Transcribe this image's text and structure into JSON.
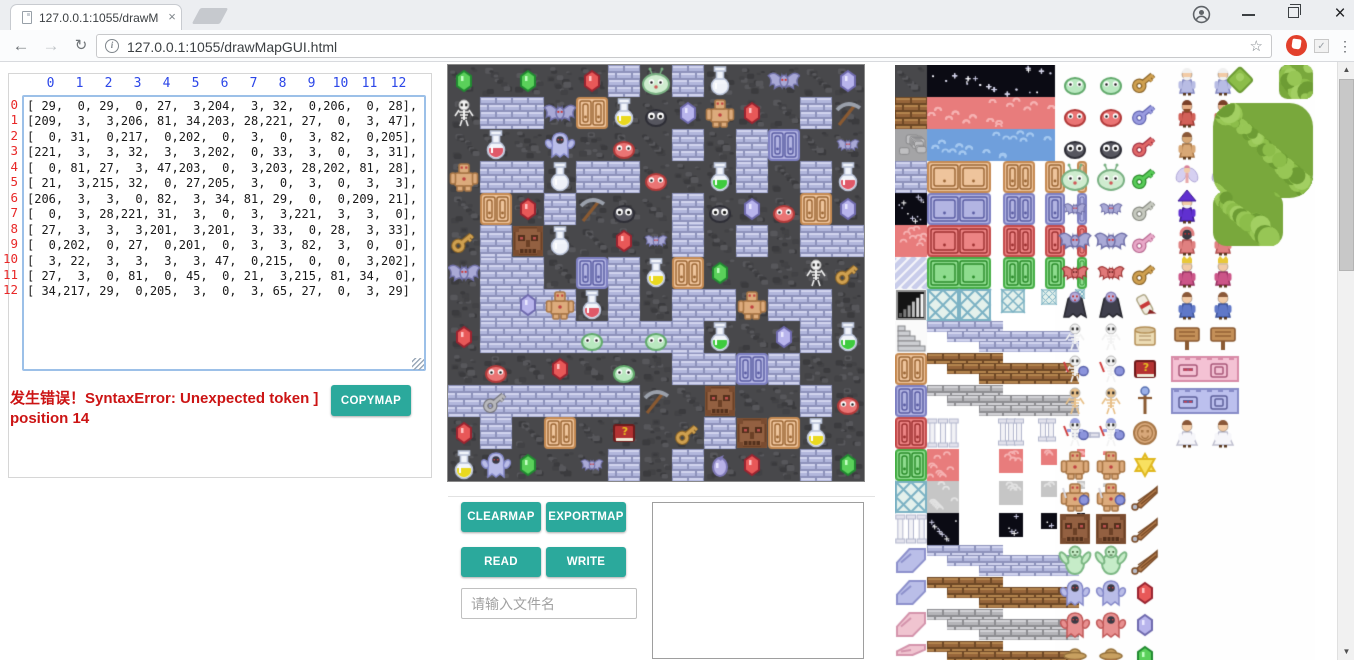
{
  "browser": {
    "tab": {
      "title": "127.0.0.1:1055/drawMa",
      "close": "×"
    },
    "window": {
      "minimize": "—",
      "close": "×"
    },
    "toolbar": {
      "back": "←",
      "forward": "→",
      "reload": "↻",
      "info": "i",
      "url": "127.0.0.1:1055/drawMapGUI.html",
      "bookmark_star": "☆",
      "extension_check": "✓",
      "menu_dots": "⋮"
    }
  },
  "left_panel": {
    "col_headers": [
      "0",
      "1",
      "2",
      "3",
      "4",
      "5",
      "6",
      "7",
      "8",
      "9",
      "10",
      "11",
      "12"
    ],
    "row_headers": [
      "0",
      "1",
      "2",
      "3",
      "4",
      "5",
      "6",
      "7",
      "8",
      "9",
      "10",
      "11",
      "12"
    ],
    "matrix_rows": [
      "[ 29,  0, 29,  0, 27,  3,204,  3, 32,  0,206,  0, 28],",
      "[209,  3,  3,206, 81, 34,203, 28,221, 27,  0,  3, 47],",
      "[  0, 31,  0,217,  0,202,  0,  3,  0,  3, 82,  0,205],",
      "[221,  3,  3, 32,  3,  3,202,  0, 33,  3,  0,  3, 31],",
      "[  0, 81, 27,  3, 47,203,  0,  3,203, 28,202, 81, 28],",
      "[ 21,  3,215, 32,  0, 27,205,  3,  0,  3,  0,  3,  3],",
      "[206,  3,  3,  0, 82,  3, 34, 81, 29,  0,  0,209, 21],",
      "[  0,  3, 28,221, 31,  3,  0,  3,  3,221,  3,  3,  0],",
      "[ 27,  3,  3,  3,201,  3,201,  3, 33,  0, 28,  3, 33],",
      "[  0,202,  0, 27,  0,201,  0,  3,  3, 82,  3,  0,  0],",
      "[  3, 22,  3,  3,  3,  3, 47,  0,215,  0,  0,  3,202],",
      "[ 27,  3,  0, 81,  0, 45,  0, 21,  3,215, 81, 34,  0],",
      "[ 34,217, 29,  0,205,  3,  0,  3, 65, 27,  0,  3, 29]"
    ],
    "error_line1": "发生错误！SyntaxError: Unexpected token ]",
    "error_line2": "position 14",
    "copymap": "COPYMAP"
  },
  "controls": {
    "clearmap": "CLEARMAP",
    "exportmap": "EXPORTMAP",
    "read": "READ",
    "write": "WRITE",
    "filename_placeholder": "请输入文件名"
  },
  "colors": {
    "accent_teal": "#2ba99c",
    "error_red": "#cc1414",
    "header_blue": "#2b46e8",
    "row_red": "#e82828"
  },
  "map": {
    "tile_size": 32,
    "grid": [
      [
        29,
        0,
        29,
        0,
        27,
        3,
        204,
        3,
        32,
        0,
        206,
        0,
        28
      ],
      [
        209,
        3,
        3,
        206,
        81,
        34,
        203,
        28,
        221,
        27,
        0,
        3,
        47
      ],
      [
        0,
        31,
        0,
        217,
        0,
        202,
        0,
        3,
        0,
        3,
        82,
        0,
        205
      ],
      [
        221,
        3,
        3,
        32,
        3,
        3,
        202,
        0,
        33,
        3,
        0,
        3,
        31
      ],
      [
        0,
        81,
        27,
        3,
        47,
        203,
        0,
        3,
        203,
        28,
        202,
        81,
        28
      ],
      [
        21,
        3,
        215,
        32,
        0,
        27,
        205,
        3,
        0,
        3,
        0,
        3,
        3
      ],
      [
        206,
        3,
        3,
        0,
        82,
        3,
        34,
        81,
        29,
        0,
        0,
        209,
        21
      ],
      [
        0,
        3,
        28,
        221,
        31,
        3,
        0,
        3,
        3,
        221,
        3,
        3,
        0
      ],
      [
        27,
        3,
        3,
        3,
        201,
        3,
        201,
        3,
        33,
        0,
        28,
        3,
        33
      ],
      [
        0,
        202,
        0,
        27,
        0,
        201,
        0,
        3,
        3,
        82,
        3,
        0,
        0
      ],
      [
        3,
        22,
        3,
        3,
        3,
        3,
        47,
        0,
        215,
        0,
        0,
        3,
        202
      ],
      [
        27,
        3,
        0,
        81,
        0,
        45,
        0,
        21,
        3,
        215,
        81,
        34,
        0
      ],
      [
        34,
        217,
        29,
        0,
        205,
        3,
        0,
        3,
        65,
        27,
        0,
        3,
        29
      ]
    ],
    "floor_bg_cells": [
      [
        7,
        2
      ],
      [
        7,
        3
      ],
      [
        8,
        4
      ],
      [
        8,
        6
      ],
      [
        10,
        1
      ]
    ],
    "legend": {
      "0": "dark-wall",
      "3": "brick-floor",
      "21": "gold-key",
      "22": "silver-key",
      "27": "red-gem",
      "28": "purple-gem",
      "29": "green-gem",
      "31": "red-potion",
      "32": "white-potion",
      "33": "green-potion",
      "34": "yellow-potion",
      "45": "red-book",
      "47": "pickaxe",
      "65": "purple-orb",
      "81": "orange-door",
      "82": "blue-door",
      "201": "green-slime",
      "202": "red-slime",
      "203": "dark-slime",
      "204": "big-slime",
      "205": "small-bat",
      "206": "big-bat",
      "209": "skeleton",
      "215": "stone-face",
      "217": "ghost",
      "221": "golem"
    }
  },
  "tileset": {
    "terrain_ops": [
      [
        "wall",
        0,
        0,
        32,
        32,
        ""
      ],
      [
        "brick",
        0,
        32,
        32,
        32,
        "brown"
      ],
      [
        "stone",
        0,
        64,
        32,
        32,
        ""
      ],
      [
        "brick",
        0,
        96,
        32,
        32,
        "blue"
      ],
      [
        "starry",
        0,
        128,
        32,
        32,
        ""
      ],
      [
        "mochi",
        0,
        160,
        32,
        32,
        "red"
      ],
      [
        "diag",
        0,
        192,
        32,
        32,
        ""
      ],
      [
        "gauge",
        0,
        224,
        32,
        32,
        ""
      ],
      [
        "stairs",
        0,
        256,
        32,
        32,
        ""
      ],
      [
        "door",
        0,
        288,
        32,
        32,
        "orange"
      ],
      [
        "door",
        0,
        320,
        32,
        32,
        "blue"
      ],
      [
        "door",
        0,
        352,
        32,
        32,
        "red"
      ],
      [
        "door",
        0,
        384,
        32,
        32,
        "green"
      ],
      [
        "lattice",
        0,
        416,
        32,
        32,
        ""
      ],
      [
        "pillar",
        0,
        448,
        32,
        32,
        ""
      ],
      [
        "ramp",
        0,
        480,
        32,
        32,
        "blue"
      ],
      [
        "ramp",
        0,
        512,
        32,
        32,
        "blue"
      ],
      [
        "ramp",
        0,
        544,
        32,
        32,
        "pink"
      ],
      [
        "ramp",
        0,
        576,
        32,
        19,
        "pink"
      ],
      [
        "starry",
        32,
        0,
        128,
        32,
        ""
      ],
      [
        "mochi",
        32,
        32,
        128,
        32,
        "red"
      ],
      [
        "mochi",
        32,
        64,
        128,
        32,
        "blue"
      ],
      [
        "door",
        32,
        96,
        64,
        32,
        "orange"
      ],
      [
        "door",
        108,
        96,
        32,
        32,
        "orange"
      ],
      [
        "door",
        150,
        96,
        20,
        32,
        "orange"
      ],
      [
        "door",
        182,
        96,
        10,
        32,
        "orange"
      ],
      [
        "door",
        32,
        128,
        64,
        32,
        "blue"
      ],
      [
        "door",
        108,
        128,
        32,
        32,
        "blue"
      ],
      [
        "door",
        150,
        128,
        20,
        32,
        "blue"
      ],
      [
        "door",
        182,
        128,
        10,
        32,
        "blue"
      ],
      [
        "door",
        32,
        160,
        64,
        32,
        "red"
      ],
      [
        "door",
        108,
        160,
        32,
        32,
        "red"
      ],
      [
        "door",
        150,
        160,
        20,
        32,
        "red"
      ],
      [
        "door",
        182,
        160,
        10,
        32,
        "red"
      ],
      [
        "door",
        32,
        192,
        64,
        32,
        "green"
      ],
      [
        "door",
        108,
        192,
        32,
        32,
        "green"
      ],
      [
        "door",
        150,
        192,
        20,
        32,
        "green"
      ],
      [
        "door",
        182,
        192,
        10,
        32,
        "green"
      ],
      [
        "lattice",
        32,
        224,
        32,
        32,
        ""
      ],
      [
        "lattice",
        64,
        224,
        32,
        32,
        ""
      ],
      [
        "lattice",
        106,
        224,
        24,
        24,
        ""
      ],
      [
        "lattice",
        146,
        224,
        16,
        16,
        ""
      ],
      [
        "lattice",
        180,
        224,
        10,
        10,
        ""
      ],
      [
        "steps",
        32,
        256,
        0,
        0,
        "blue"
      ],
      [
        "steps",
        32,
        288,
        0,
        0,
        "brown"
      ],
      [
        "steps",
        32,
        320,
        0,
        0,
        "gray"
      ],
      [
        "pillar",
        32,
        352,
        32,
        32,
        ""
      ],
      [
        "pillar",
        104,
        352,
        24,
        30,
        ""
      ],
      [
        "pillar",
        144,
        352,
        16,
        26,
        ""
      ],
      [
        "pillar",
        178,
        366,
        26,
        8,
        ""
      ],
      [
        "mochi",
        32,
        384,
        32,
        32,
        "red"
      ],
      [
        "mochi",
        104,
        384,
        24,
        24,
        "red"
      ],
      [
        "mochi",
        146,
        384,
        16,
        16,
        "red"
      ],
      [
        "mochi",
        182,
        384,
        8,
        8,
        "red"
      ],
      [
        "mochi",
        208,
        386,
        4,
        4,
        "red"
      ],
      [
        "mochi",
        32,
        416,
        32,
        32,
        "gray"
      ],
      [
        "mochi",
        104,
        416,
        24,
        24,
        "gray"
      ],
      [
        "mochi",
        146,
        416,
        16,
        16,
        "gray"
      ],
      [
        "mochi",
        182,
        416,
        8,
        8,
        "gray"
      ],
      [
        "mochi",
        208,
        418,
        4,
        4,
        "gray"
      ],
      [
        "starry",
        32,
        448,
        32,
        32,
        ""
      ],
      [
        "starry",
        104,
        448,
        24,
        24,
        ""
      ],
      [
        "starry",
        146,
        448,
        16,
        16,
        ""
      ],
      [
        "starry",
        182,
        448,
        8,
        8,
        ""
      ],
      [
        "starry",
        208,
        450,
        4,
        4,
        ""
      ],
      [
        "steps",
        32,
        480,
        0,
        0,
        "blue"
      ],
      [
        "steps",
        32,
        512,
        0,
        0,
        "brown"
      ],
      [
        "steps",
        32,
        544,
        0,
        0,
        "gray"
      ],
      [
        "steps",
        32,
        576,
        0,
        0,
        "brown"
      ]
    ],
    "monster_cols": [
      164,
      200
    ],
    "monster_rows": [
      [
        "slime",
        "green"
      ],
      [
        "slime",
        "red"
      ],
      [
        "slime",
        "dark"
      ],
      [
        "slime",
        "big"
      ],
      [
        "bat",
        "small"
      ],
      [
        "bat",
        "big"
      ],
      [
        "bat",
        "red"
      ],
      [
        "vampire",
        ""
      ],
      [
        "skeleton",
        "plain"
      ],
      [
        "skeleton",
        "shield"
      ],
      [
        "skeleton",
        "orange"
      ],
      [
        "skeleton",
        "armor"
      ],
      [
        "golem",
        "plain"
      ],
      [
        "golem",
        "armor"
      ],
      [
        "face",
        ""
      ],
      [
        "troll",
        ""
      ],
      [
        "ghost",
        "blue"
      ],
      [
        "ghost",
        "red"
      ],
      [
        "hatman",
        ""
      ]
    ],
    "item_col": 236,
    "item_rows": [
      [
        "key",
        "tan"
      ],
      [
        "key",
        "blue"
      ],
      [
        "key",
        "red"
      ],
      [
        "key",
        "green"
      ],
      [
        "key",
        "gray"
      ],
      [
        "key",
        "pink"
      ],
      [
        "key",
        "tan"
      ],
      [
        "scroll",
        "red"
      ],
      [
        "scroll",
        "tan"
      ],
      [
        "book",
        ""
      ],
      [
        "staff",
        ""
      ],
      [
        "coin",
        ""
      ],
      [
        "star",
        ""
      ],
      [
        "wing",
        ""
      ],
      [
        "wing",
        ""
      ],
      [
        "wing",
        ""
      ],
      [
        "gem",
        "red"
      ],
      [
        "gem",
        "purple"
      ],
      [
        "gem",
        "green"
      ]
    ],
    "char_cols": [
      276,
      312
    ],
    "char_rows": [
      [
        "human",
        "oldman"
      ],
      [
        "human",
        "dwarf"
      ],
      [
        "human",
        "barbarian"
      ],
      [
        "fairy",
        ""
      ],
      [
        "human",
        "wizard"
      ],
      [
        "human",
        "reaper"
      ],
      [
        "human",
        "king"
      ],
      [
        "human",
        "knight"
      ],
      [
        "sign",
        ""
      ],
      [
        "facewall",
        "pink"
      ],
      [
        "facewall",
        "blue"
      ],
      [
        "human",
        "princess"
      ]
    ],
    "trees": [
      [
        "bush",
        332,
        2,
        26,
        26,
        ""
      ],
      [
        "tree",
        384,
        0,
        34,
        34,
        ""
      ],
      [
        "tree",
        318,
        38,
        100,
        95,
        ""
      ],
      [
        "tree",
        318,
        126,
        70,
        55,
        ""
      ]
    ]
  }
}
